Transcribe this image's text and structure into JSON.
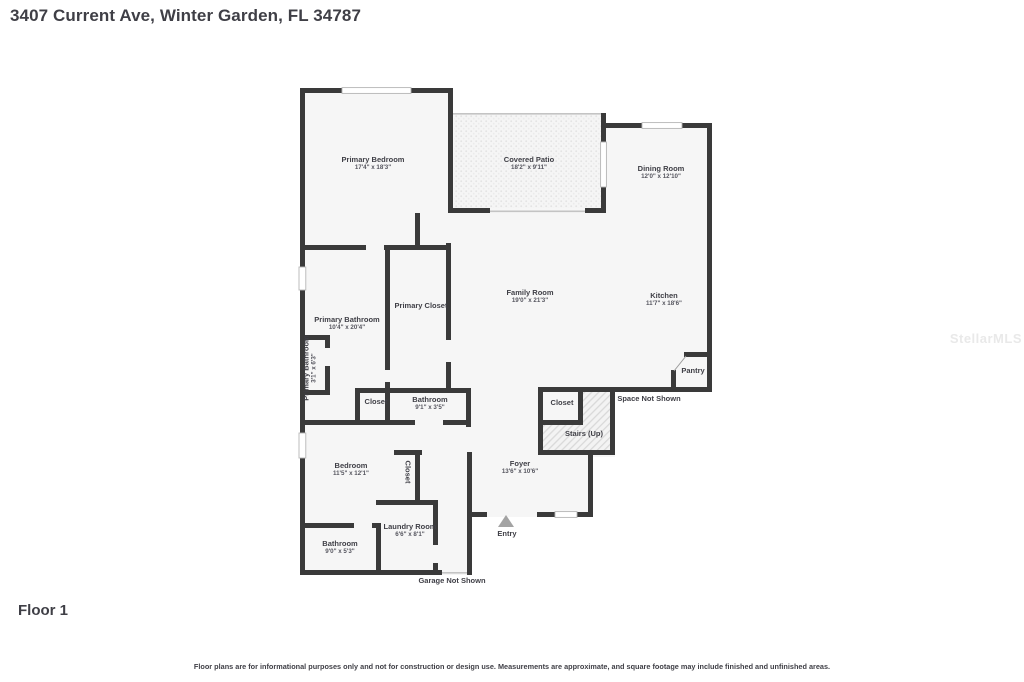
{
  "page": {
    "title": "3407 Current Ave, Winter Garden, FL 34787",
    "floor_label": "Floor 1",
    "watermark": "StellarMLS",
    "disclaimer": "Floor plans are for informational purposes only and not for construction or design use. Measurements are approximate, and square footage may include finished and unfinished areas."
  },
  "colors": {
    "wall": "#3a3a3a",
    "label_text": "#3f3f46",
    "dim_text": "#55555e",
    "floor_fill": "#f6f6f6",
    "entry_arrow": "#a3a3a3"
  },
  "rooms": {
    "primary_bedroom": {
      "label": "Primary Bedroom",
      "dims": "17'4\" x 18'3\""
    },
    "covered_patio": {
      "label": "Covered Patio",
      "dims": "18'2\" x 9'11\""
    },
    "dining_room": {
      "label": "Dining Room",
      "dims": "12'0\" x 12'10\""
    },
    "family_room": {
      "label": "Family Room",
      "dims": "19'0\" x 21'3\""
    },
    "kitchen": {
      "label": "Kitchen",
      "dims": "11'7\" x 18'6\""
    },
    "primary_closet": {
      "label": "Primary Closet"
    },
    "primary_bathroom": {
      "label": "Primary Bathroom",
      "dims": "10'4\" x 20'4\""
    },
    "primary_bathroom_small": {
      "label": "Primary Bathroom",
      "dims": "3'1\" x 6'3\""
    },
    "closet_mid": {
      "label": "Closet"
    },
    "bathroom_mid": {
      "label": "Bathroom",
      "dims": "9'1\" x 3'5\""
    },
    "pantry": {
      "label": "Pantry"
    },
    "space_not_shown": {
      "label": "Space Not Shown"
    },
    "closet_stairs": {
      "label": "Closet"
    },
    "stairs_up": {
      "label": "Stairs (Up)"
    },
    "bedroom": {
      "label": "Bedroom",
      "dims": "11'5\" x 12'1\""
    },
    "closet_bedroom": {
      "label": "Closet"
    },
    "foyer": {
      "label": "Foyer",
      "dims": "13'6\" x 10'6\""
    },
    "entry": {
      "label": "Entry"
    },
    "laundry_room": {
      "label": "Laundry Room",
      "dims": "6'6\" x 8'1\""
    },
    "bathroom_bottom": {
      "label": "Bathroom",
      "dims": "9'0\" x 5'3\""
    },
    "garage_not_shown": {
      "label": "Garage Not Shown"
    }
  }
}
